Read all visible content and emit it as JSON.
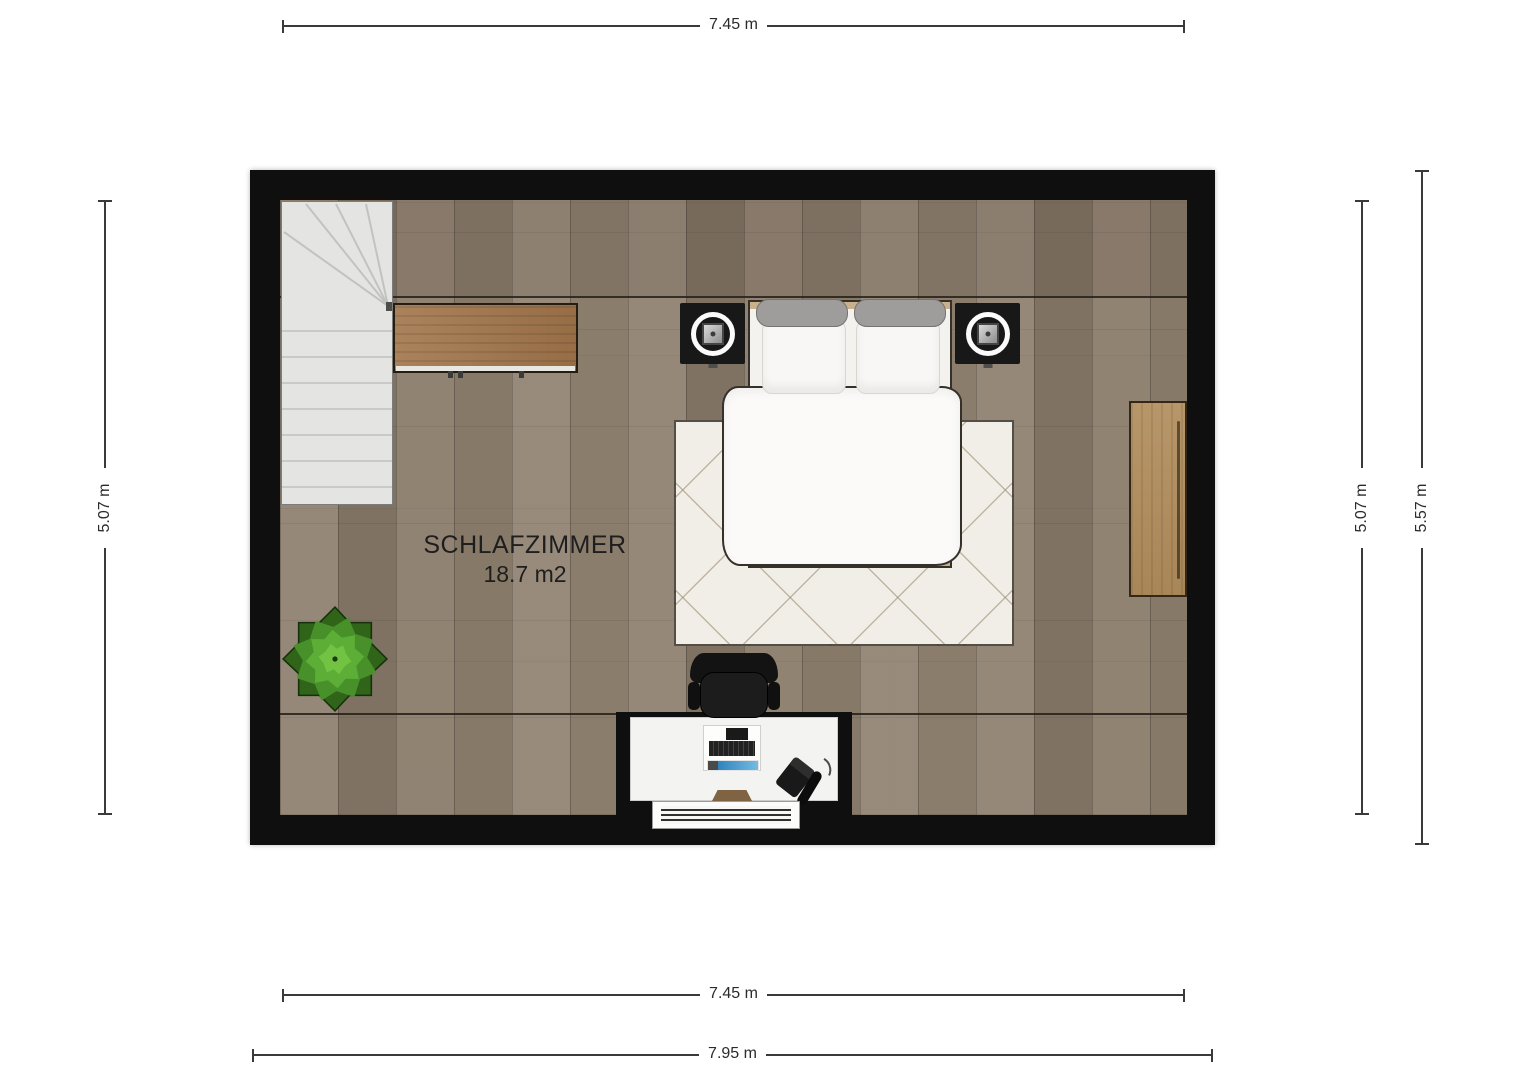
{
  "room": {
    "name": "SCHLAFZIMMER",
    "area": "18.7 m2"
  },
  "dimensions": {
    "top_width": "7.45 m",
    "bottom_width_inner": "7.45 m",
    "bottom_width_outer": "7.95 m",
    "left_height": "5.07 m",
    "right_height_inner": "5.07 m",
    "right_height_outer": "5.57 m"
  },
  "furniture": [
    "staircase",
    "sideboard",
    "double-bed",
    "nightstand-with-lamp-left",
    "nightstand-with-lamp-right",
    "area-rug",
    "wardrobe",
    "potted-plant",
    "office-chair",
    "desk",
    "computer",
    "telephone",
    "radiator"
  ],
  "colors": {
    "background": "#ffffff",
    "wall": "#0f0f0f",
    "floor": "#8d7f6e",
    "floor-line": "#241f18",
    "stairs": "#e4e5e3",
    "sideboard": "#a0744a",
    "wardrobe": "#b18d5c",
    "bed-frame": "#c9b18e",
    "bedding": "#f8f7f5",
    "bolster": "#9e9d9b",
    "nightstand": "#181818",
    "rug": "#f0eee6",
    "plant-dark": "#2f6419",
    "plant-mid": "#48912a",
    "plant-light": "#5cae36",
    "plant-highlight": "#72c243",
    "desk": "#f3f3f2",
    "chair": "#161616",
    "screen-blue": "#3a93cc",
    "dim-line": "#3a3a3a",
    "dim-text": "#2b2b2b",
    "label-text": "#1e1e1e"
  }
}
